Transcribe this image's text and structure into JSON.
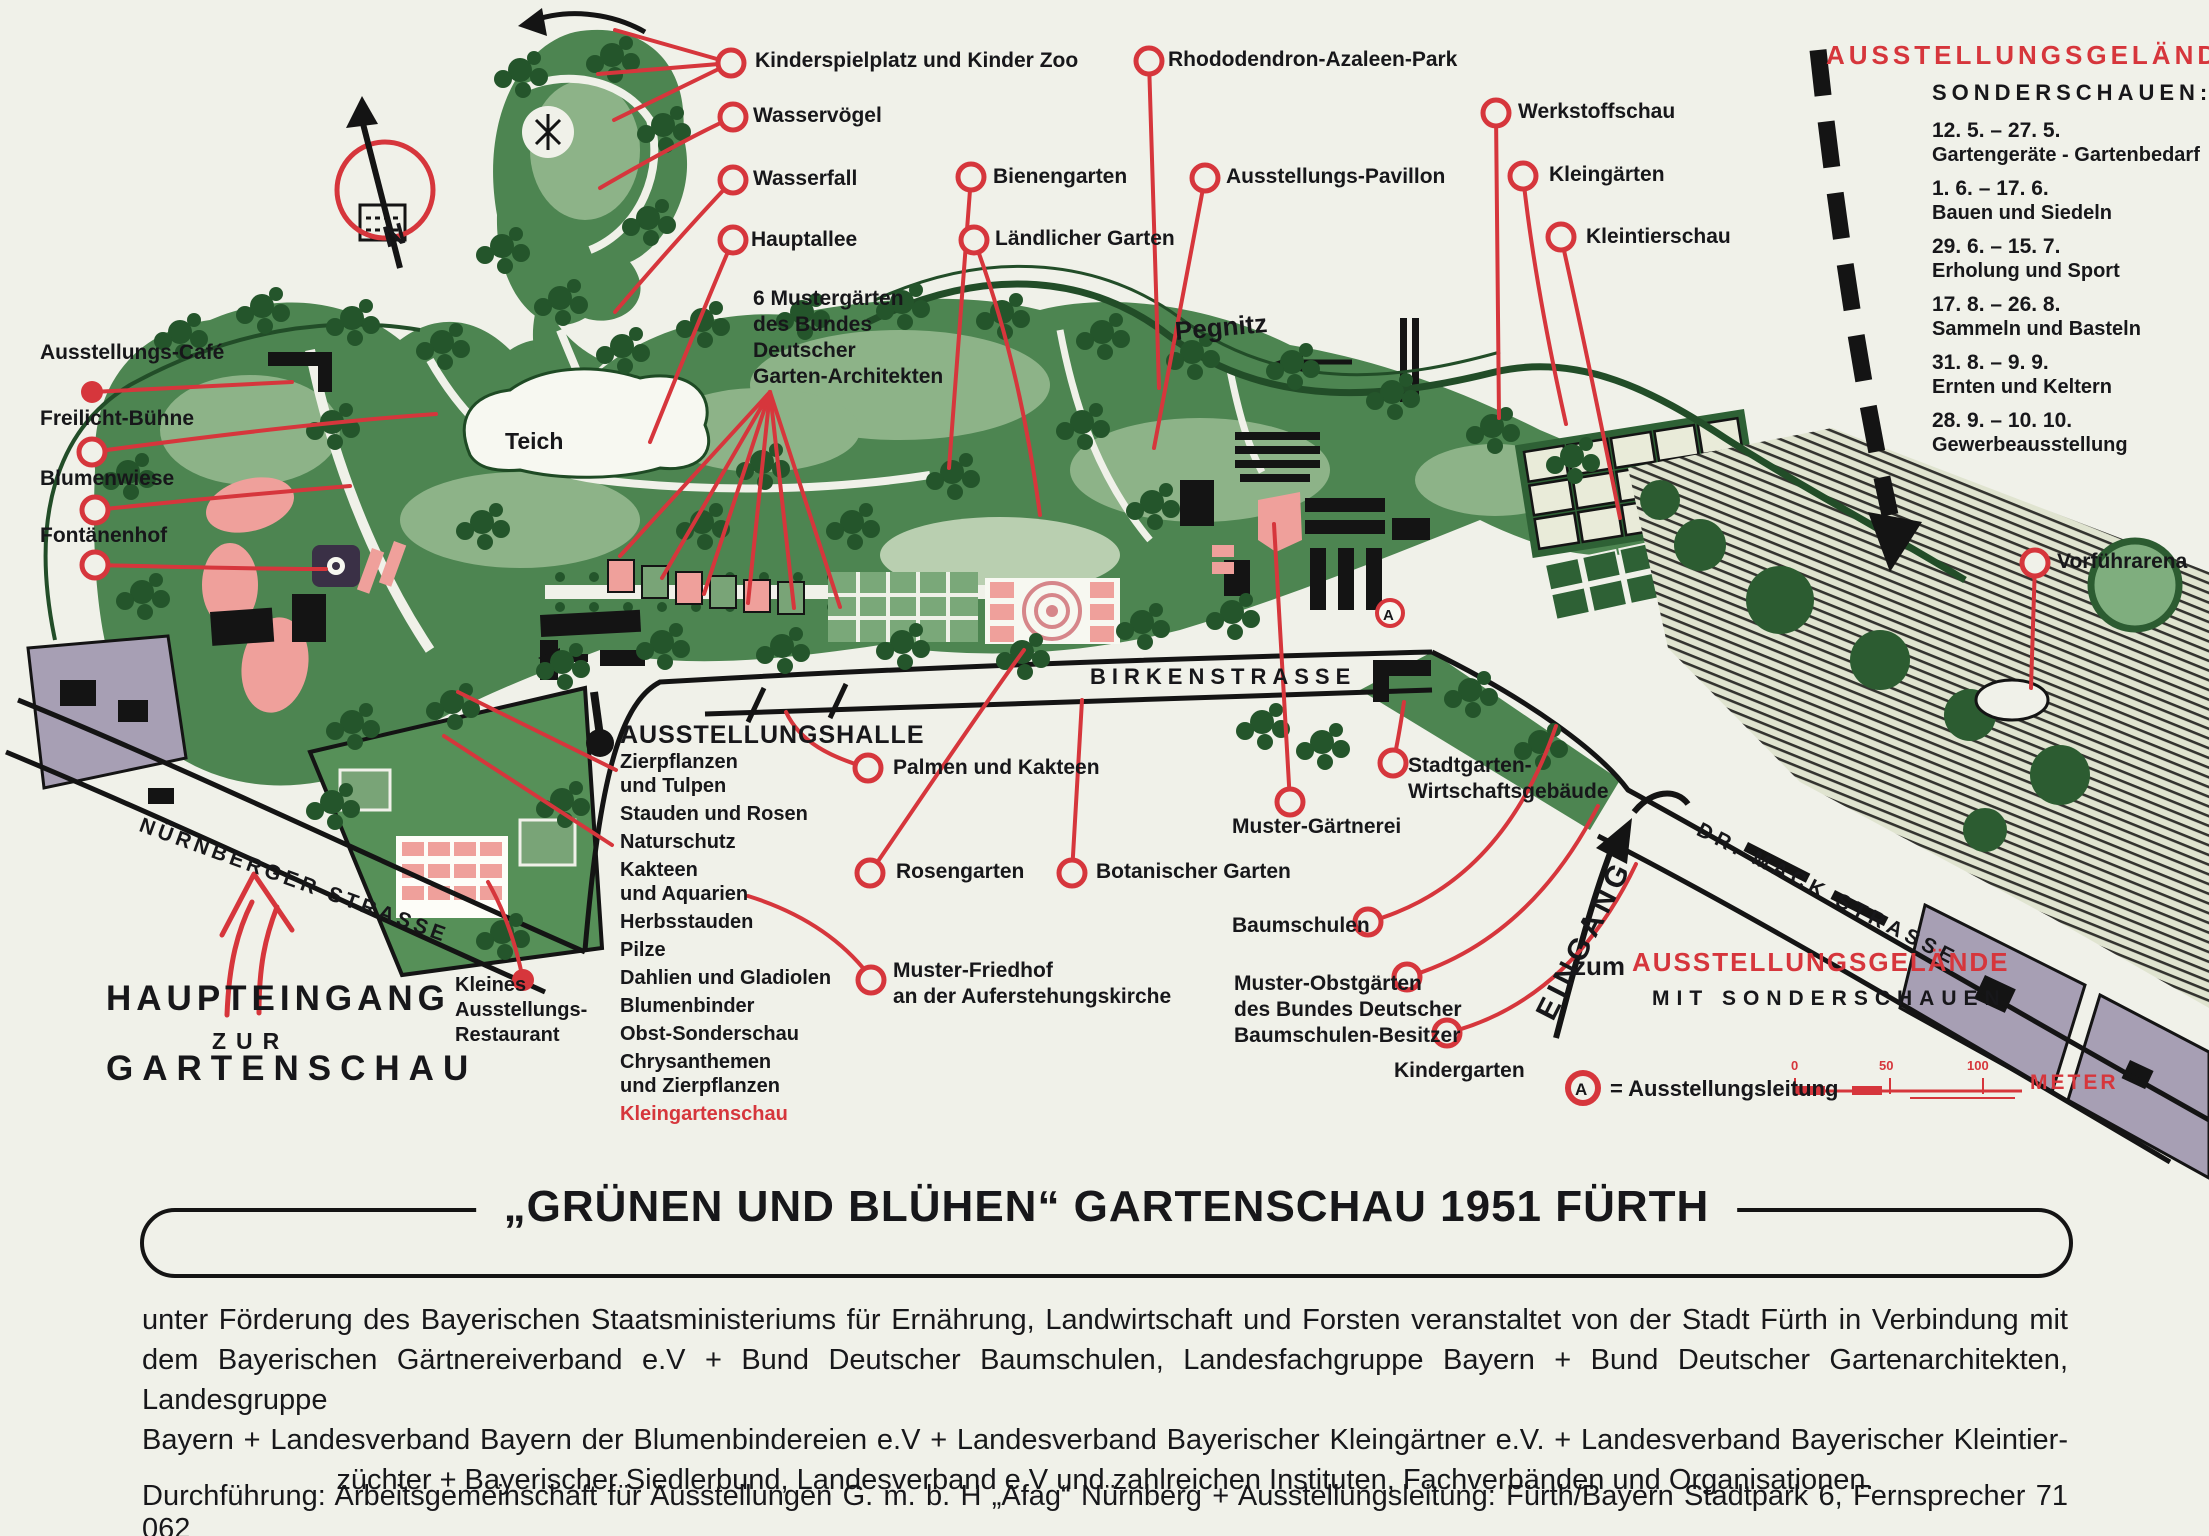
{
  "colors": {
    "red": "#d6363c",
    "black": "#17171a",
    "cream": "#f0f1e9",
    "park_green": "#4d8551",
    "dark_green": "#24552b",
    "pink": "#efa09b",
    "gray_violet": "#a79fb4"
  },
  "compass": {
    "n": "N"
  },
  "top_right": {
    "title": "AUSSTELLUNGSGELÄNDE",
    "subhead": "SONDERSCHAUEN:",
    "shows": [
      {
        "dates": "12. 5.  –  27. 5.",
        "name": "Gartengeräte - Gartenbedarf"
      },
      {
        "dates": "1. 6.  –  17. 6.",
        "name": "Bauen und Siedeln"
      },
      {
        "dates": "29. 6.  –  15. 7.",
        "name": "Erholung und Sport"
      },
      {
        "dates": "17. 8.  –  26. 8.",
        "name": "Sammeln und Basteln"
      },
      {
        "dates": "31. 8.  –  9. 9.",
        "name": "Ernten und Keltern"
      },
      {
        "dates": "28. 9.  –  10. 10.",
        "name": "Gewerbeausstellung"
      }
    ]
  },
  "labels": {
    "kinderspielplatz": "Kinderspielplatz und Kinder Zoo",
    "wasservoegel": "Wasservögel",
    "wasserfall": "Wasserfall",
    "hauptallee": "Hauptallee",
    "mustergaerten": "6 Mustergärten\ndes Bundes\nDeutscher\nGarten-Architekten",
    "bienengarten": "Bienengarten",
    "laendlicher_garten": "Ländlicher Garten",
    "rhododendron": "Rhododendron-Azaleen-Park",
    "pavillon": "Ausstellungs-Pavillon",
    "werkstoffschau": "Werkstoffschau",
    "kleingaerten": "Kleingärten",
    "kleintierschau": "Kleintierschau",
    "vorfuehrarena": "Vorführarena",
    "cafe": "Ausstellungs-Café",
    "freilicht": "Freilicht-Bühne",
    "blumenwiese": "Blumenwiese",
    "fontaenenhof": "Fontänenhof",
    "teich": "Teich",
    "palmen": "Palmen und Kakteen",
    "rosengarten": "Rosengarten",
    "friedhof": "Muster-Friedhof\nan der Auferstehungskirche",
    "botanischer": "Botanischer Garten",
    "muster_gaertnerei": "Muster-Gärtnerei",
    "stadtgarten": "Stadtgarten-\nWirtschaftsgebäude",
    "baumschulen": "Baumschulen",
    "obstgaerten": "Muster-Obstgärten\ndes Bundes Deutscher\nBaumschulen-Besitzer",
    "kindergarten": "Kindergarten",
    "restaurant": "Kleines\nAusstellungs-\nRestaurant"
  },
  "streets": {
    "nuernberger": "NÜRNBERGER STRASSE",
    "birken": "BIRKENSTRASSE",
    "drmack": "DR. MACK STRASSE",
    "pegnitz": "Pegnitz"
  },
  "entrances": {
    "haupteingang_1": "HAUPTEINGANG",
    "haupteingang_2": "ZUR",
    "haupteingang_3": "GARTENSCHAU",
    "eingang": "EINGANG",
    "zum": "zum",
    "gelaende_red": "AUSSTELLUNGSGELÄNDE",
    "mit": "MIT SONDERSCHAUEN"
  },
  "halle": {
    "title": "AUSSTELLUNGSHALLE",
    "items": [
      "Zierpflanzen\nund Tulpen",
      "Stauden und Rosen",
      "Naturschutz",
      "Kakteen\nund Aquarien",
      "Herbsstauden",
      "Pilze",
      "Dahlien und Gladiolen",
      "Blumenbinder",
      "Obst-Sonderschau",
      "Chrysanthemen\nund Zierpflanzen",
      "Kleingartenschau"
    ]
  },
  "legend": {
    "a": "A",
    "a_text": "= Ausstellungsleitung",
    "ticks": [
      "0",
      "50",
      "100"
    ],
    "meter": "METER"
  },
  "footer": {
    "title": "„GRÜNEN UND BLÜHEN“ GARTENSCHAU 1951 FÜRTH",
    "para": [
      "unter Förderung des Bayerischen Staatsministeriums für Ernährung, Landwirtschaft und Forsten veranstaltet von der Stadt Fürth in Verbindung mit",
      "dem Bayerischen Gärtnereiverband e.V + Bund Deutscher Baumschulen, Landesfachgruppe Bayern + Bund Deutscher Gartenarchitekten, Landesgruppe",
      "Bayern + Landesverband Bayern der Blumenbindereien e.V + Landesverband Bayerischer Kleingärtner e.V. + Landesverband Bayerischer Kleintier-",
      "züchter + Bayerischer Siedlerbund, Landesverband e.V und zahlreichen Instituten, Fachverbänden und Organisationen."
    ],
    "durchfuehrung": "Durchführung: Arbeitsgemeinschaft für Ausstellungen G. m. b. H „Afag“ Nürnberg + Ausstellungsleitung: Fürth/Bayern Stadtpark 6, Fernsprecher 71 062"
  }
}
